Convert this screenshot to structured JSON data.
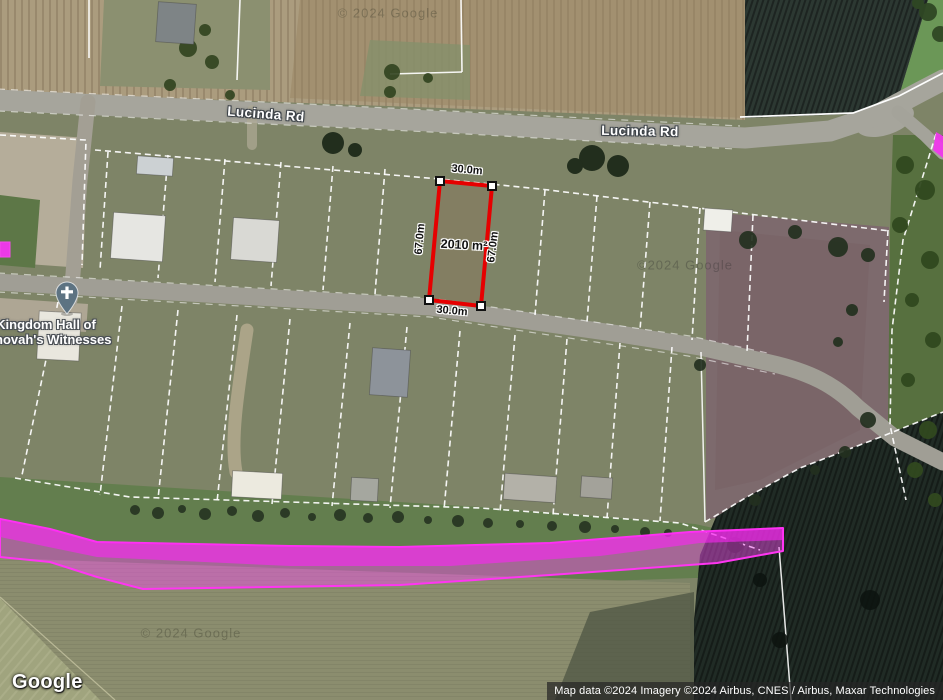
{
  "map": {
    "road_labels": {
      "west": "Lucinda Rd",
      "east": "Lucinda Rd"
    },
    "poi": {
      "line1": "Kingdom Hall of",
      "line2": "Jehovah's Witnesses"
    },
    "measurement": {
      "area": "2010 m²",
      "top": "30.0m",
      "bottom": "30.0m",
      "left": "67.0m",
      "right": "67.0m",
      "outline_color": "#e60000"
    },
    "highlight_color": "#ff35f2",
    "watermarks": {
      "top": "© 2024 Google",
      "middle": "©2024 Google",
      "bottom": "© 2024 Google"
    }
  },
  "footer": {
    "logo": "Google",
    "attribution": "Map data ©2024 Imagery ©2024 Airbus, CNES / Airbus, Maxar Technologies"
  }
}
